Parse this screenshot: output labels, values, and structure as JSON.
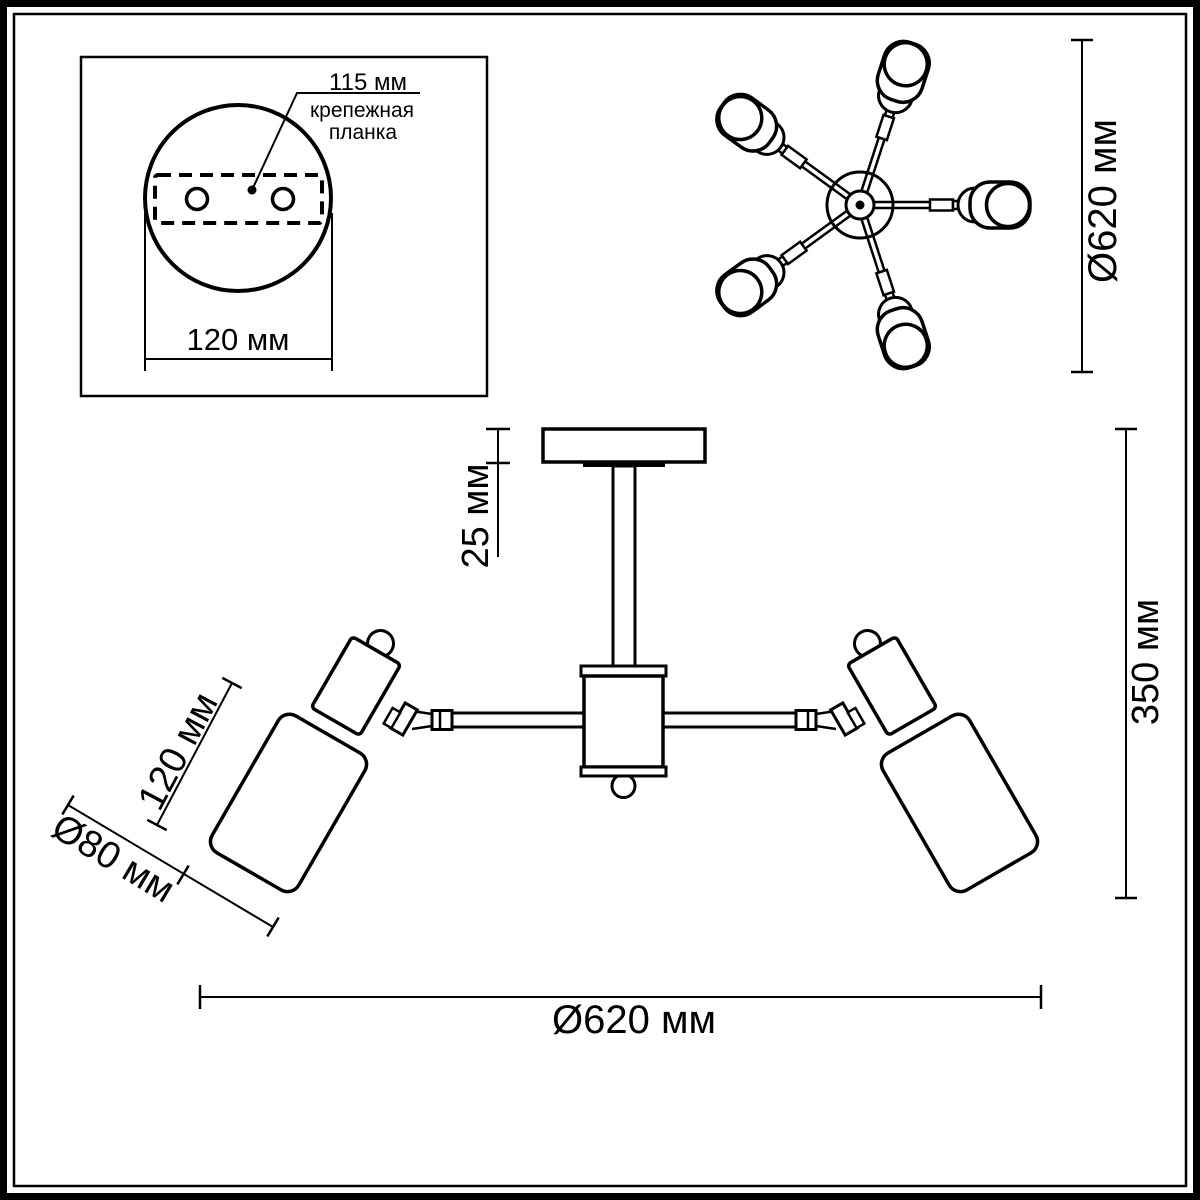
{
  "drawing": {
    "inset": {
      "hole_spacing_label": "115 мм",
      "plate_name_line1": "крепежная",
      "plate_name_line2": "планка",
      "plate_width_label": "120 мм"
    },
    "top_view": {
      "diameter_label": "Ø620 мм"
    },
    "side_view": {
      "canopy_height_label": "25 мм",
      "shade_length_label": "120 мм",
      "shade_diameter_label": "Ø80 мм",
      "total_height_label": "350 мм",
      "total_width_label": "Ø620 мм"
    },
    "colors": {
      "line": "#000000",
      "background": "#ffffff"
    }
  }
}
